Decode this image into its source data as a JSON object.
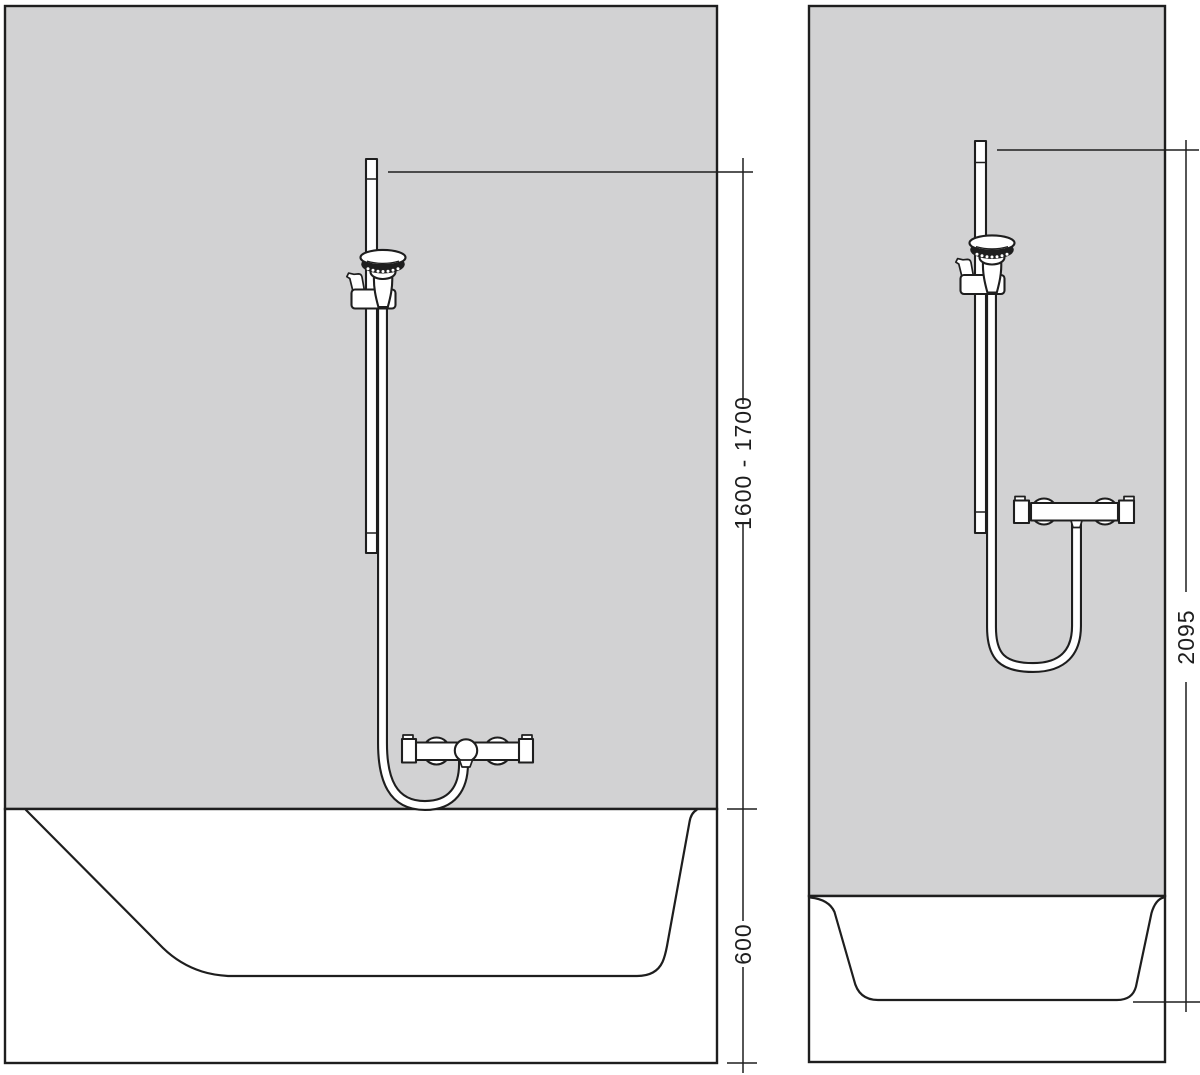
{
  "diagram": {
    "front_view": {
      "dim_bar_height": "1600 - 1700",
      "dim_tub_height": "600"
    },
    "side_view": {
      "dim_total_height": "2095"
    }
  },
  "colors": {
    "wall": "#d2d2d3",
    "line": "#1e1e1e",
    "background": "#ffffff"
  }
}
